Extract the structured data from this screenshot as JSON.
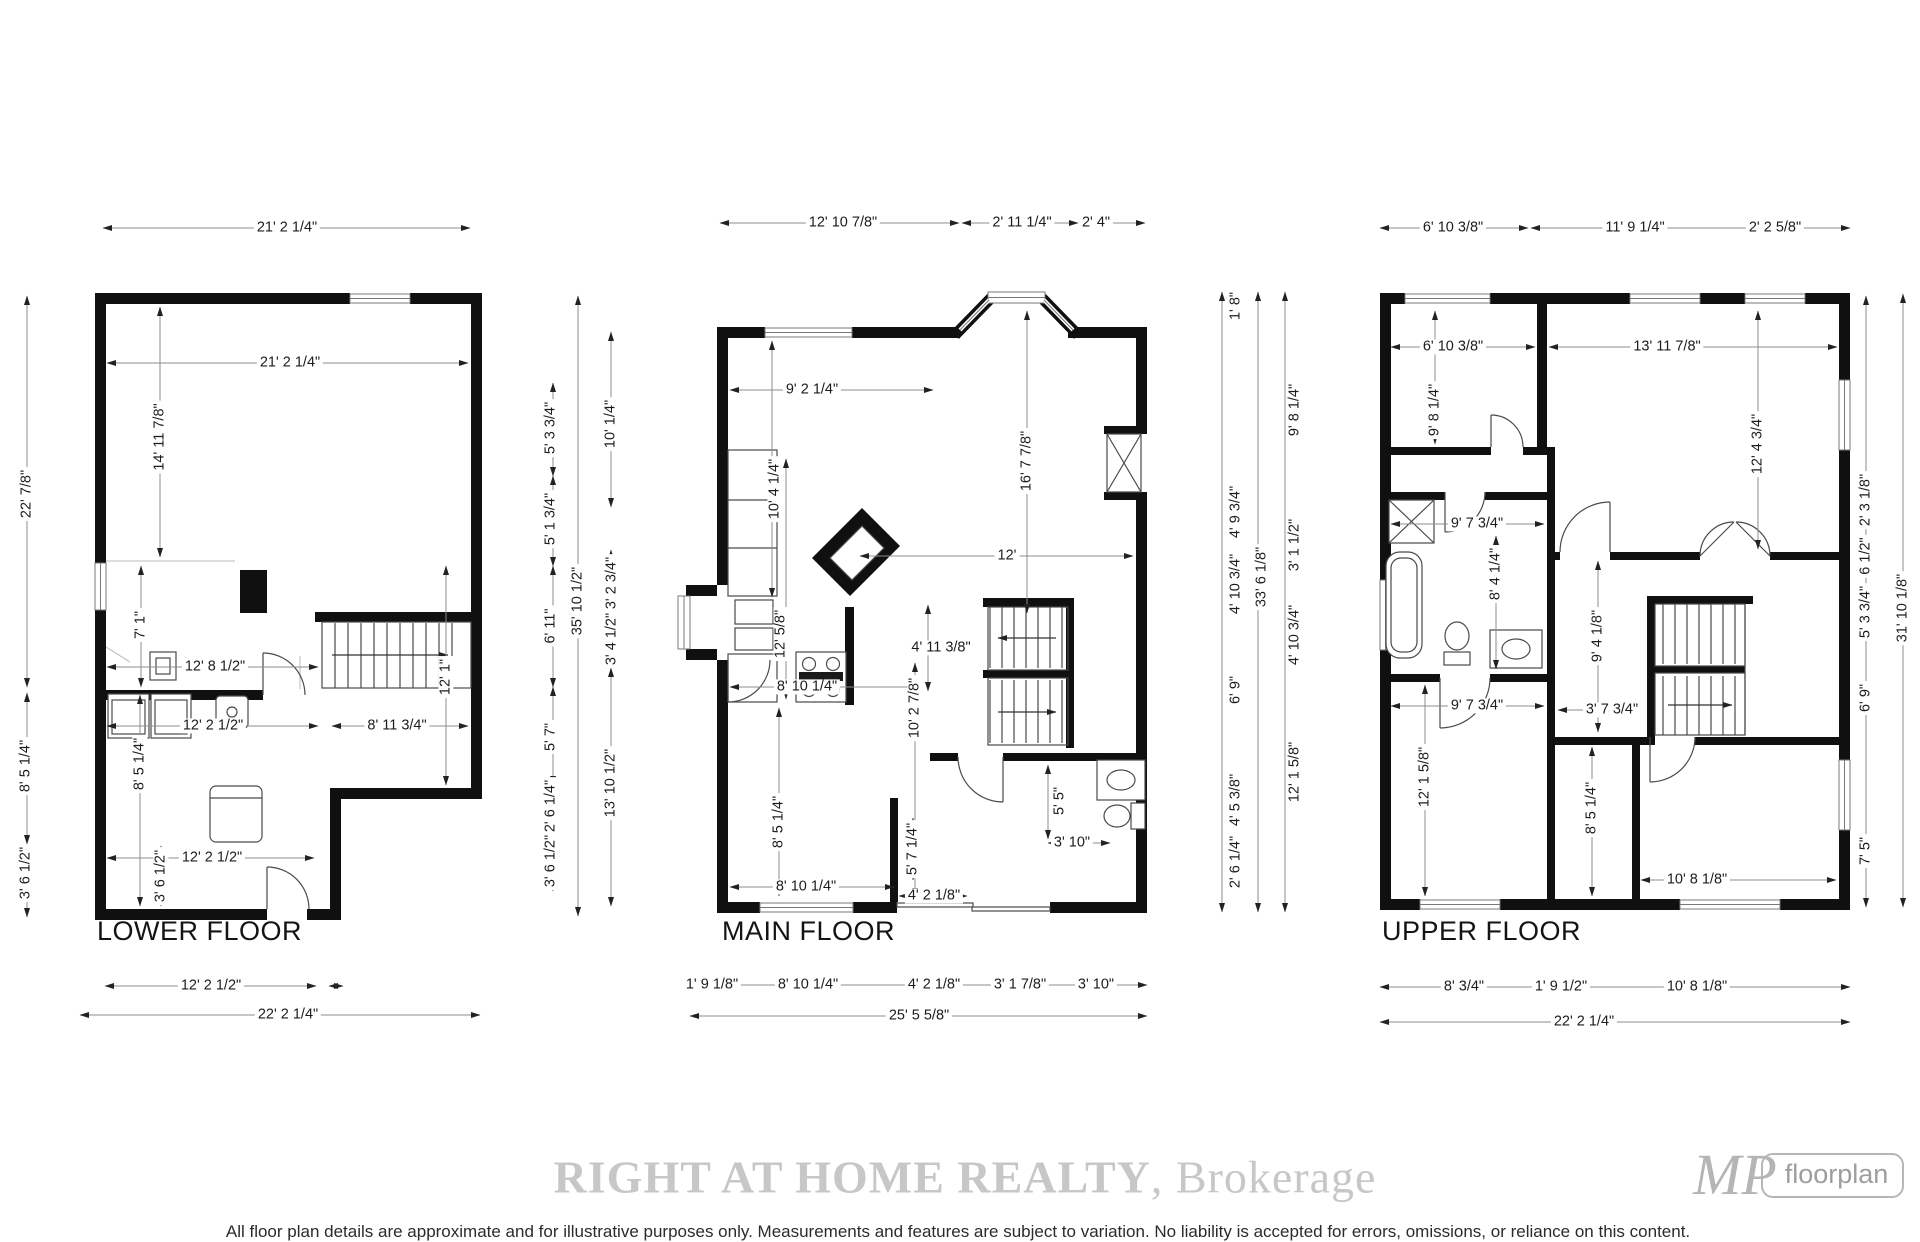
{
  "floors": {
    "lower": {
      "label": "LOWER FLOOR",
      "top": [
        "21' 2 1/4\""
      ],
      "left": [
        "22' 7/8\"",
        "8' 5 1/4\"",
        "3' 6 1/2\""
      ],
      "inner": [
        "21' 2 1/4\"",
        "14' 11 7/8\"",
        "7' 1\"",
        "12' 8 1/2\"",
        "12' 2 1/2\"",
        "8' 5 1/4\"",
        "8' 11 3/4\"",
        "12' 1\"",
        "12' 2 1/2\"",
        "3' 6 1/2\""
      ],
      "bottom": [
        "12' 2 1/2\"",
        "22' 2 1/4\""
      ]
    },
    "main": {
      "label": "MAIN FLOOR",
      "top": [
        "12' 10 7/8\"",
        "2' 11 1/4\"",
        "2' 4\""
      ],
      "left_segments": [
        "5' 3 3/4\"",
        "5' 1 3/4\"",
        "6' 11\"",
        "5' 7\"",
        "2' 6 1/4\"",
        "3' 6 1/2\""
      ],
      "left_overall": [
        "35' 10 1/2\""
      ],
      "left_inner": [
        "10' 1/4\"",
        "3' 2 3/4\"",
        "3' 4 1/2\"",
        "13' 10 1/2\""
      ],
      "inner": [
        "9' 2 1/4\"",
        "10' 4 1/4\"",
        "16' 7 7/8\"",
        "12'",
        "12' 5/8\"",
        "8' 10 1/4\"",
        "4' 11 3/8\"",
        "10' 2 7/8\"",
        "8' 5 1/4\"",
        "8' 10 1/4\"",
        "4' 2 1/8\"",
        "5' 7 1/4\"",
        "5' 5\"",
        "3' 10\""
      ],
      "right_segments": [
        "1' 8\"",
        "4' 9 3/4\"",
        "4' 10 3/4\"",
        "6' 9\"",
        "4' 5 3/8\"",
        "2' 6 1/4\""
      ],
      "right_overall": [
        "33' 6 1/8\""
      ],
      "right_inner": [
        "9' 8 1/4\"",
        "3' 1 1/2\"",
        "4' 10 3/4\"",
        "12' 1 5/8\""
      ],
      "bottom": [
        "1' 9 1/8\"",
        "8' 10 1/4\"",
        "4' 2 1/8\"",
        "3' 1 7/8\"",
        "3' 10\"",
        "25' 5 5/8\""
      ]
    },
    "upper": {
      "label": "UPPER FLOOR",
      "top": [
        "6' 10 3/8\"",
        "11' 9 1/4\"",
        "2' 2 5/8\""
      ],
      "inner": [
        "6' 10 3/8\"",
        "13' 11 7/8\"",
        "9' 8 1/4\"",
        "12' 4 3/4\"",
        "9' 7 3/4\"",
        "8' 4 1/4\"",
        "9' 4 1/8\"",
        "9' 7 3/4\"",
        "3' 7 3/4\"",
        "12' 1 5/8\"",
        "8' 5 1/4\"",
        "10' 8 1/8\""
      ],
      "right_segments": [
        "2' 3 1/8\"",
        "6 1/2\"",
        "5' 3 3/4\"",
        "6' 9\"",
        "7' 5\""
      ],
      "right_overall": [
        "31' 10 1/8\""
      ],
      "bottom": [
        "8' 3/4\"",
        "1' 9 1/2\"",
        "10' 8 1/8\"",
        "22' 2 1/4\""
      ]
    }
  },
  "footer": {
    "brokerage_bold": "RIGHT AT HOME REALTY",
    "brokerage_rest": ", Brokerage",
    "logo_monogram": "MP",
    "logo_name": "floorplan",
    "disclaimer": "All floor plan details are approximate and for illustrative purposes only. Measurements and features are subject to variation. No liability is accepted for errors, omissions, or reliance on this content."
  }
}
